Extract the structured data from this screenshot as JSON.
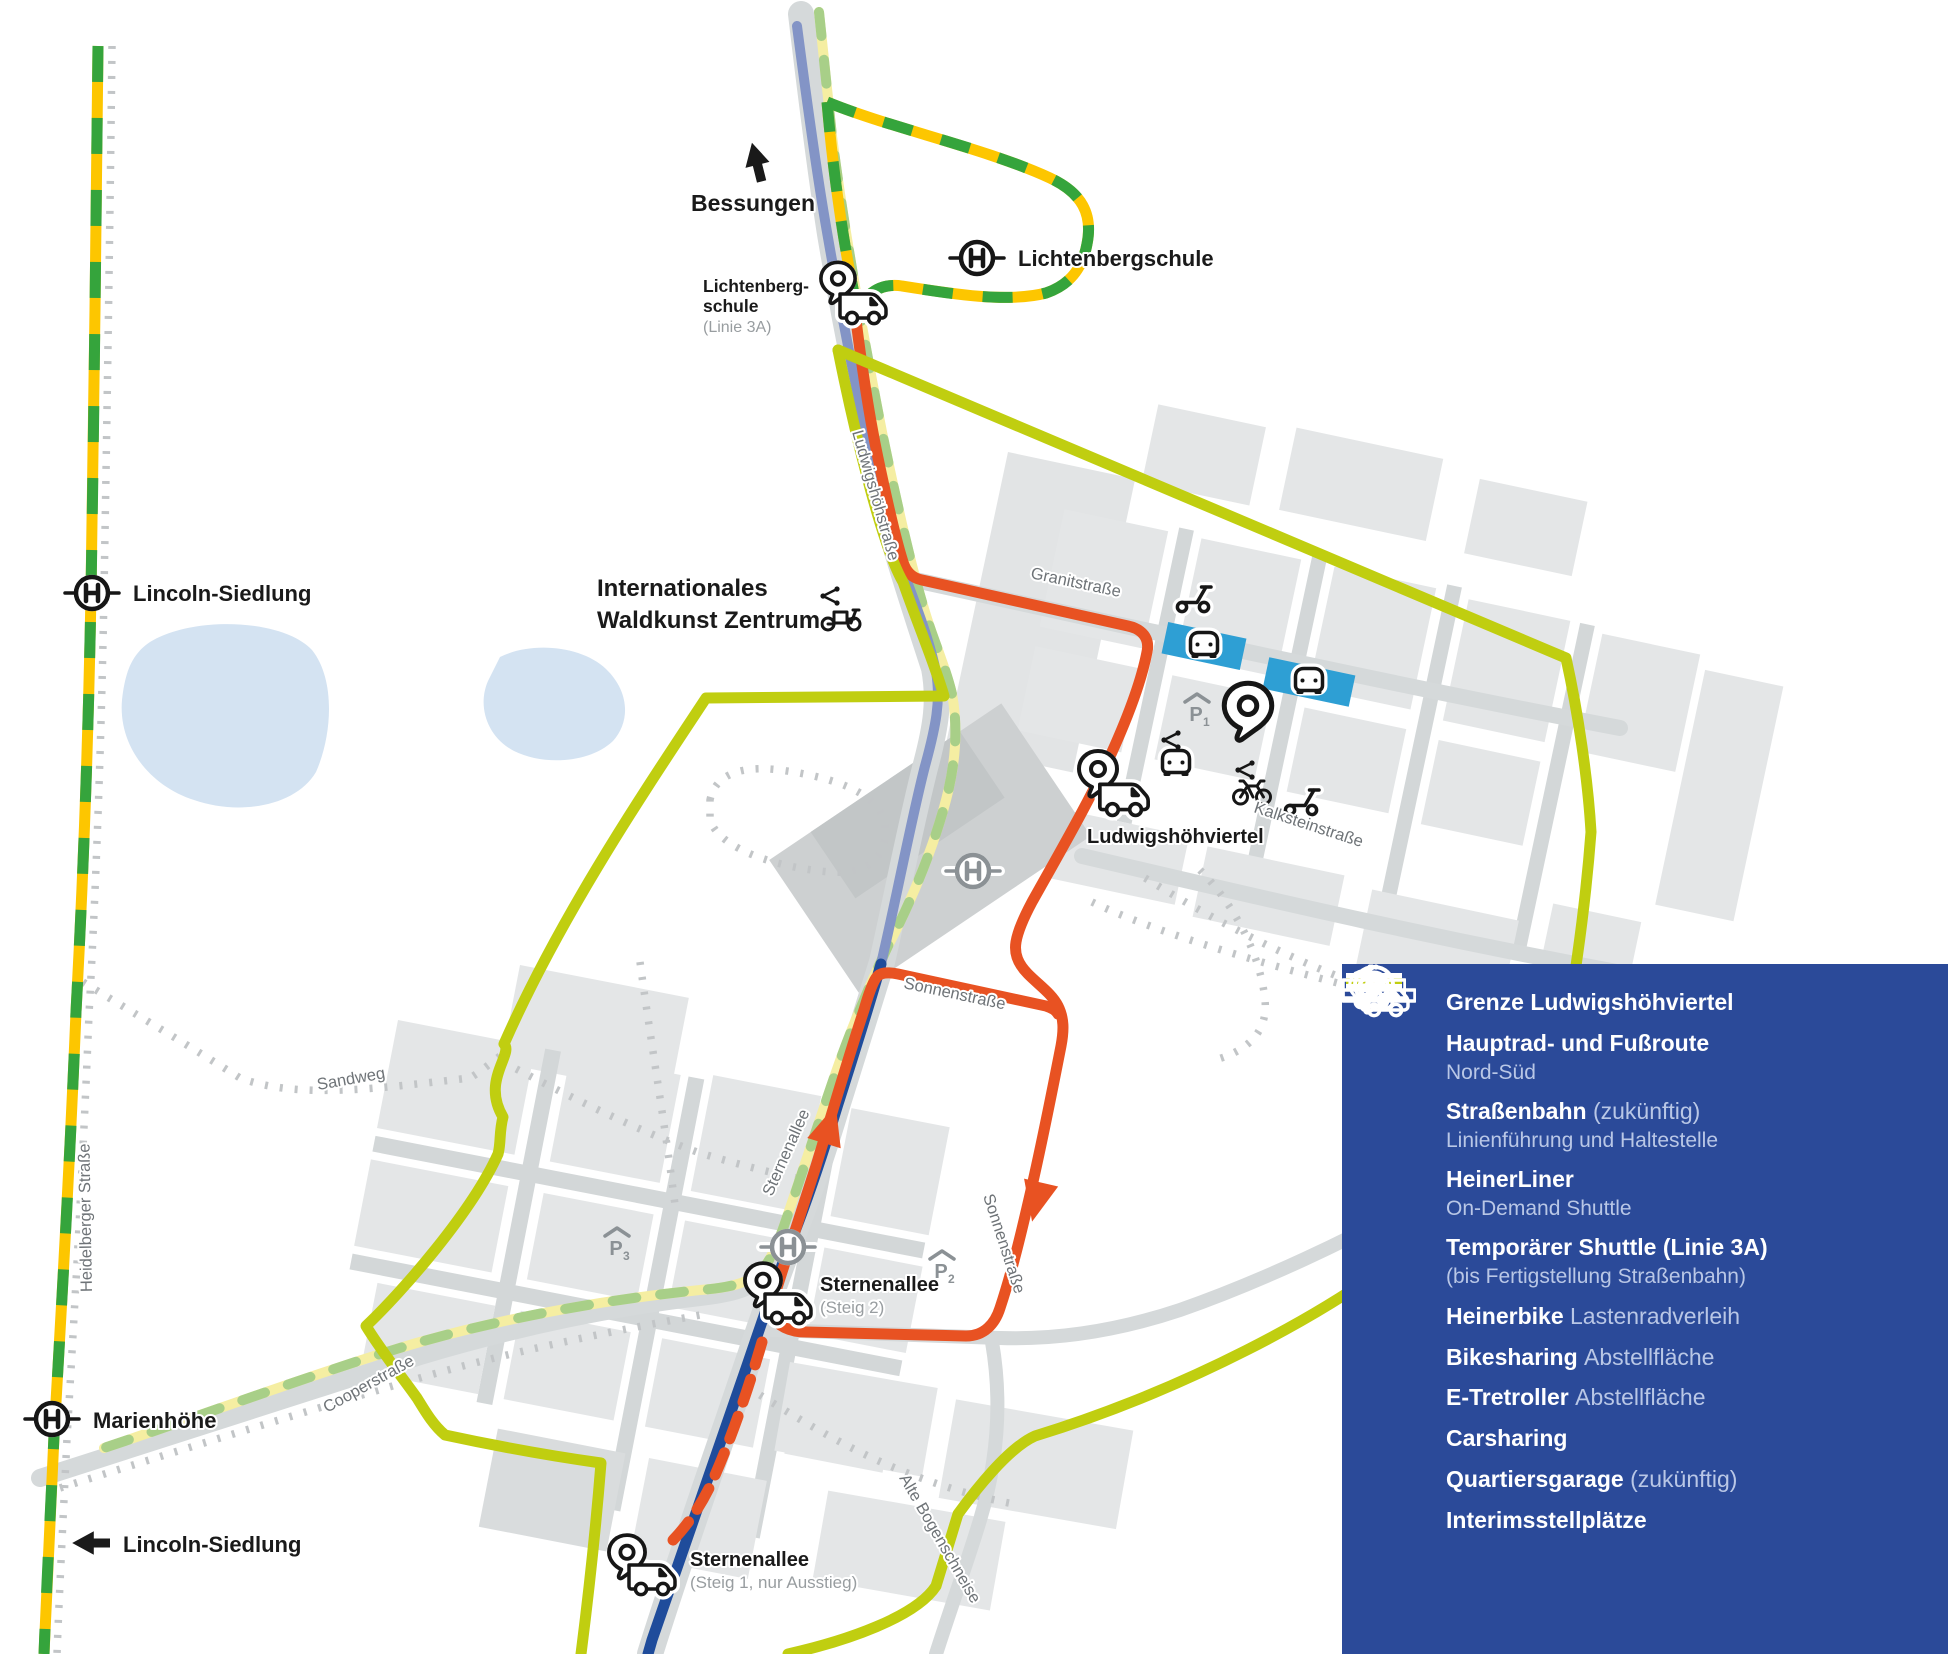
{
  "map": {
    "directions": {
      "bessungen": "Bessungen",
      "lincoln_siedlung_arrow": "Lincoln-Siedlung"
    },
    "stops": {
      "lichtenbergschule": "Lichtenbergschule",
      "lichtenberg_shuttle": {
        "l1": "Lichtenberg-",
        "l2": "schule",
        "l3": "(Linie 3A)"
      },
      "lincoln_siedlung": "Lincoln-Siedlung",
      "marienhoehe": "Marienhöhe",
      "ludwigshoehviertel": "Ludwigshöhviertel",
      "sternenallee_steig2": {
        "l1": "Sternenallee",
        "l2": "(Steig 2)"
      },
      "sternenallee_steig1": {
        "l1": "Sternenallee",
        "l2": "(Steig 1, nur Ausstieg)"
      }
    },
    "pois": {
      "waldkunst": {
        "l1": "Internationales",
        "l2": "Waldkunst Zentrum"
      }
    },
    "streets": {
      "ludwigshoehstrasse": "Ludwigshöhstraße",
      "granitstrasse": "Granitstraße",
      "kalksteinstrasse": "Kalksteinstraße",
      "sonnenstrasse_1": "Sonnenstraße",
      "sonnenstrasse_2": "Sonnenstraße",
      "sternenallee": "Sternenallee",
      "sandweg": "Sandweg",
      "cooperstrasse": "Cooperstraße",
      "heidelberger_strasse": "Heidelberger Straße",
      "alte_bogenschneise": "Alte Bogenschneise"
    },
    "garages": {
      "p1": {
        "letter": "P",
        "num": "1"
      },
      "p2": {
        "letter": "P",
        "num": "2"
      },
      "p3": {
        "letter": "P",
        "num": "3"
      }
    }
  },
  "legend": {
    "garage_letter": "P",
    "rows": [
      {
        "label": "Grenze Ludwigshöhviertel"
      },
      {
        "label": "Hauptrad- und Fußroute",
        "sub": "Nord-Süd"
      },
      {
        "label": "Straßenbahn",
        "label2": "(zukünftig)",
        "sub": "Linienführung und Haltestelle"
      },
      {
        "label": "HeinerLiner",
        "sub": "On-Demand Shuttle"
      },
      {
        "label": "Temporärer Shuttle (Linie 3A)",
        "sub": "(bis Fertigstellung Straßenbahn)"
      },
      {
        "label": "Heinerbike",
        "label2": "Lastenradverleih"
      },
      {
        "label": "Bikesharing",
        "label2": "Abstellfläche"
      },
      {
        "label": "E-Tretroller",
        "label2": "Abstellfläche"
      },
      {
        "label": "Carsharing"
      },
      {
        "label": "Quartiersgarage",
        "label2": "(zukünftig)"
      },
      {
        "label": "Interimsstellplätze"
      }
    ]
  },
  "colors": {
    "boundary_lime": "#C0CE10",
    "shuttle_red": "#E85222",
    "bike_foot_route_blue": "#1F4C9B",
    "bike_foot_route_slate": "#8394C6",
    "tram_yellow": "#FDC600",
    "tram_green": "#35A43C",
    "future_tram_yellow": "#F5EEA2",
    "future_tram_green": "#A8CF88",
    "interim_blue": "#2E9FD4",
    "legend_background": "#2B4A99",
    "water_blue": "#D4E3F2"
  }
}
